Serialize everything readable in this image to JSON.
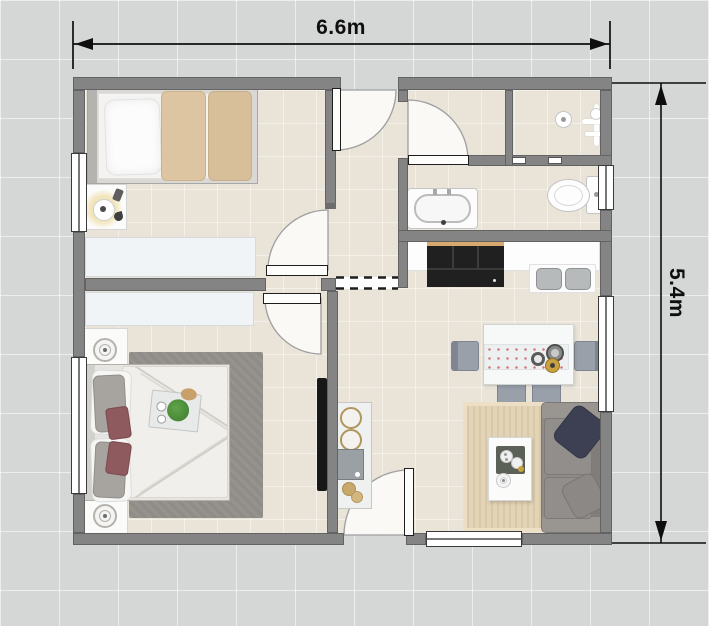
{
  "dimension_labels": {
    "width": "6.6m",
    "height": "5.4m"
  },
  "palette": {
    "page_background": "#d5d7d7",
    "grid_line": "#e7e9e9",
    "wall": "#848484",
    "floor": "#e9e3d8",
    "floor_tile_line": "#f6f1e9",
    "dimension_color": "#0e0e0e",
    "door_swing_fill": "#faf9f6",
    "window_white": "#ffffff",
    "closet_white": "#f1f4f6",
    "bedroom_rug_gray": "#908c87",
    "living_rug_tan": "#e4d4b6",
    "blanket_tan": "#d9c19c",
    "sofa_gray": "#8e8b88",
    "pillow_navy": "#3c4052",
    "pillow_maroon": "#8e5a5e",
    "plant_green": "#4d8f3a",
    "appliance_black": "#202020",
    "chair_bluegray": "#99a0aa",
    "runner_dot_red": "#d97a7a",
    "counter_wood_trim": "#d8a96e"
  },
  "furniture_icons": [
    "single-bed-icon",
    "double-bed-icon",
    "nightstand-icon",
    "table-lamp-icon",
    "spiral-lamp-icon",
    "wardrobe-icon",
    "area-rug-icon",
    "wall-tv-icon",
    "plant-tray-icon",
    "entry-console-icon",
    "shower-head-icon",
    "shower-drain-icon",
    "toilet-icon",
    "bathtub-icon",
    "kitchen-counter-icon",
    "cooktop-icon",
    "double-sink-icon",
    "dining-table-icon",
    "table-runner-icon",
    "dining-chair-icon",
    "sofa-icon",
    "coffee-table-icon",
    "serving-tray-icon",
    "door-swing-icon",
    "dimension-arrow-icon"
  ]
}
